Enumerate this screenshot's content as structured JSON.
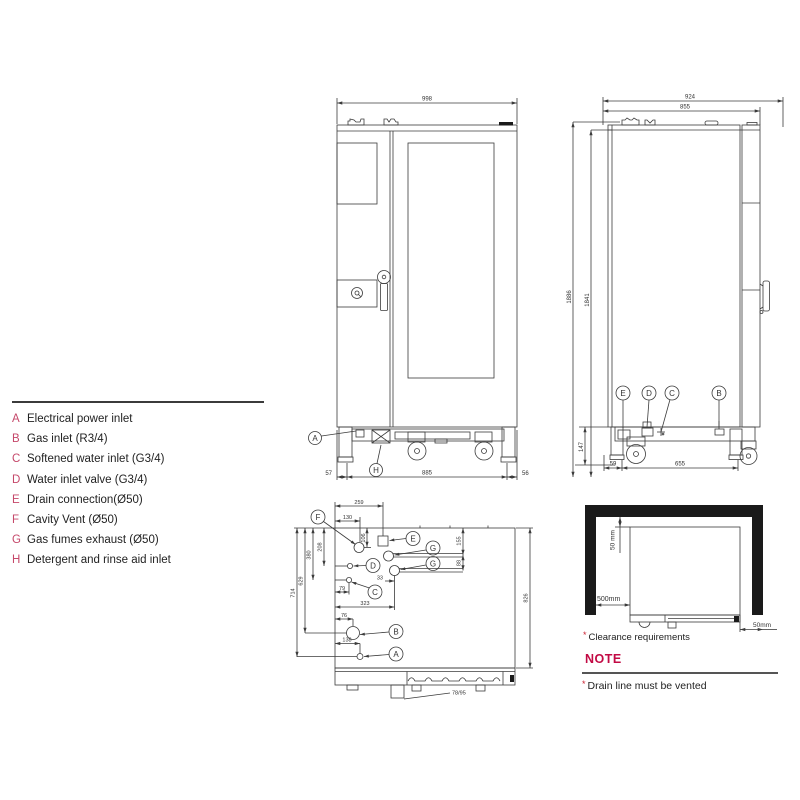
{
  "colors": {
    "drawing_line": "#3b3b3b",
    "legend_letter": "#c5486a",
    "note_title": "#c20a44",
    "asterisk": "#cc2233",
    "wall_fill": "#1a1a1a"
  },
  "legend": {
    "items": [
      {
        "key": "A",
        "label": "Electrical power inlet"
      },
      {
        "key": "B",
        "label": "Gas inlet (R3/4)"
      },
      {
        "key": "C",
        "label": "Softened water inlet (G3/4)"
      },
      {
        "key": "D",
        "label": "Water inlet valve (G3/4)"
      },
      {
        "key": "E",
        "label": "Drain connection(Ø50)"
      },
      {
        "key": "F",
        "label": "Cavity Vent (Ø50)"
      },
      {
        "key": "G",
        "label": "Gas fumes exhaust (Ø50)"
      },
      {
        "key": "H",
        "label": "Detergent and rinse aid inlet"
      }
    ]
  },
  "front_view": {
    "dims": {
      "total_width": "998",
      "left_offset": "57",
      "base_width": "885",
      "right_offset": "56"
    },
    "callouts": {
      "a": "A",
      "h": "H"
    }
  },
  "side_view": {
    "dims": {
      "total_depth": "924",
      "body_depth": "855",
      "total_height": "1886",
      "body_height": "1841",
      "base_height": "147",
      "front_offset": "59",
      "wheelbase": "655"
    },
    "callouts": {
      "e": "E",
      "d": "D",
      "c": "C",
      "b": "B"
    }
  },
  "top_view": {
    "dims": {
      "d259": "259",
      "d130": "130",
      "d106": "106",
      "d208": "208",
      "d380": "380",
      "d629": "629",
      "d714": "714",
      "d155": "155",
      "d88": "88",
      "d33": "33",
      "d79": "79",
      "d323": "323",
      "d76": "76",
      "d138": "138",
      "d826": "826",
      "d7895": "78/95"
    },
    "callouts": {
      "f": "F",
      "e": "E",
      "g1": "G",
      "g2": "G",
      "d": "D",
      "c": "C",
      "b": "B",
      "a": "A"
    }
  },
  "clearance": {
    "dims": {
      "top": "50 mm",
      "side": "500mm",
      "bottom": "50mm"
    },
    "caption_mark": "*",
    "caption": "Clearance requirements"
  },
  "note": {
    "title": "NOTE",
    "mark": "*",
    "text": "Drain line must be vented"
  }
}
